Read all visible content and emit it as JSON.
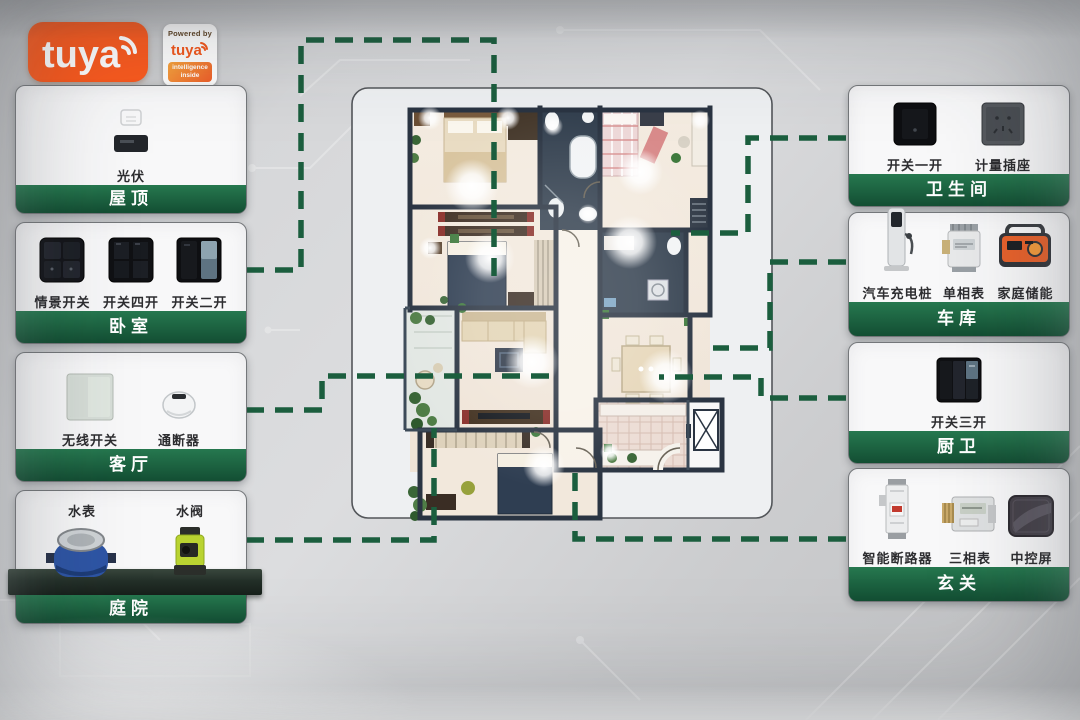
{
  "brand": {
    "logo": "tuya",
    "badge_powered": "Powered by",
    "badge_logo": "tuya",
    "badge_sub": "intelligence inside"
  },
  "colors": {
    "panel_green": "#26784f",
    "panel_green_dark": "#134e33",
    "connector_green": "#1b5e3e",
    "tuya_orange": "#fb5a1e"
  },
  "panels_left": [
    {
      "title": "屋顶",
      "devices": [
        {
          "name": "光伏",
          "icon": "solar-inverter"
        }
      ]
    },
    {
      "title": "卧室",
      "devices": [
        {
          "name": "情景开关",
          "icon": "scene-switch"
        },
        {
          "name": "开关四开",
          "icon": "switch-4gang"
        },
        {
          "name": "开关二开",
          "icon": "switch-2gang"
        }
      ]
    },
    {
      "title": "客厅",
      "devices": [
        {
          "name": "无线开关",
          "icon": "wireless-switch"
        },
        {
          "name": "通断器",
          "icon": "on-off-module"
        }
      ]
    },
    {
      "title": "庭院",
      "devices": [
        {
          "name": "水表",
          "icon": "water-meter"
        },
        {
          "name": "水阀",
          "icon": "water-valve"
        }
      ]
    }
  ],
  "panels_right": [
    {
      "title": "卫生间",
      "devices": [
        {
          "name": "开关一开",
          "icon": "switch-1gang"
        },
        {
          "name": "计量插座",
          "icon": "metering-socket"
        }
      ]
    },
    {
      "title": "车库",
      "devices": [
        {
          "name": "汽车充电桩",
          "icon": "ev-charger"
        },
        {
          "name": "单相表",
          "icon": "single-phase-meter"
        },
        {
          "name": "家庭储能",
          "icon": "home-battery"
        }
      ]
    },
    {
      "title": "厨卫",
      "devices": [
        {
          "name": "开关三开",
          "icon": "switch-3gang"
        }
      ]
    },
    {
      "title": "玄关",
      "devices": [
        {
          "name": "智能断路器",
          "icon": "smart-breaker"
        },
        {
          "name": "三相表",
          "icon": "three-phase-meter"
        },
        {
          "name": "中控屏",
          "icon": "control-screen"
        }
      ]
    }
  ]
}
